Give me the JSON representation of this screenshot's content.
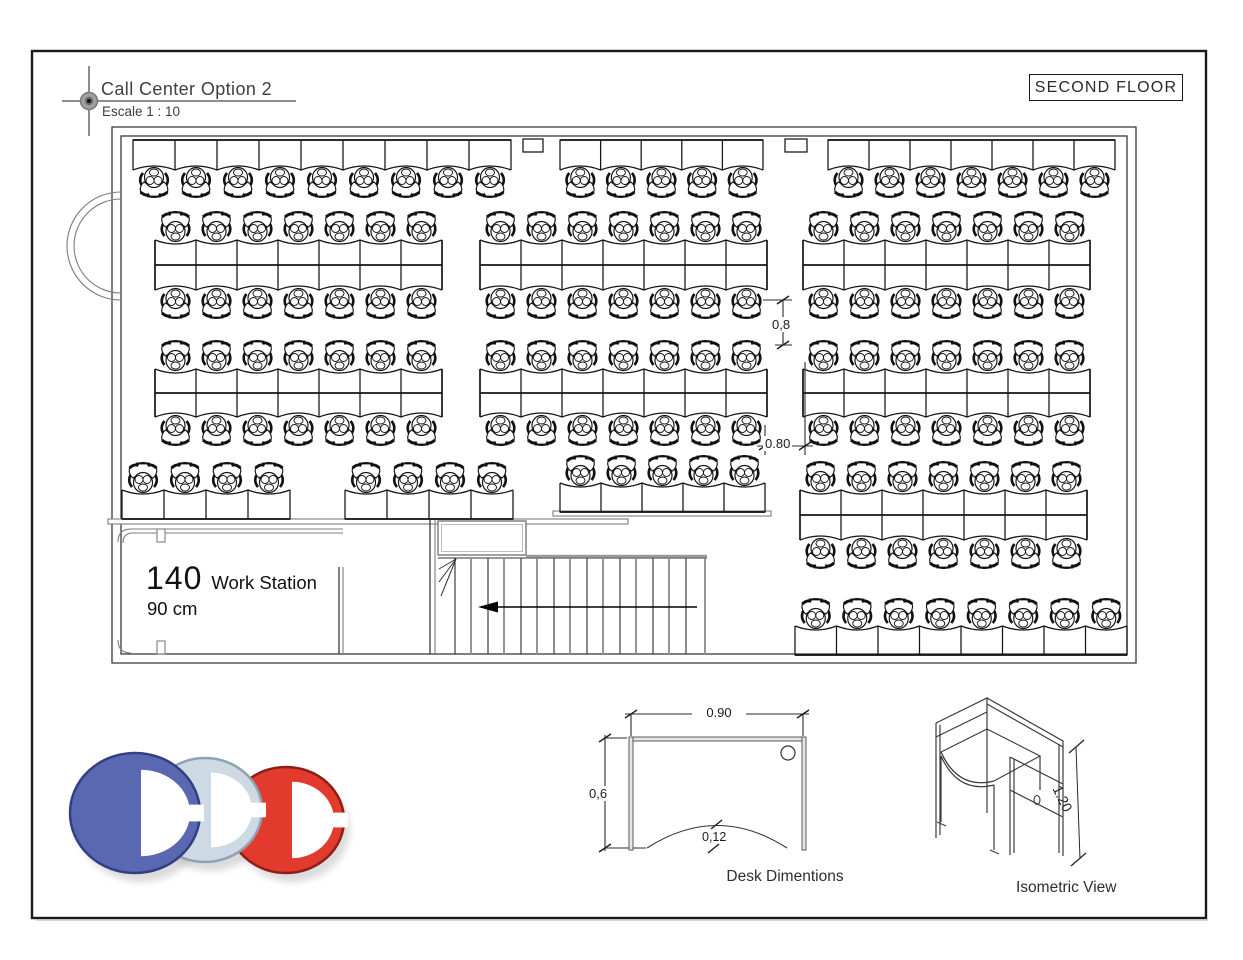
{
  "title_block": {
    "title": "Call Center Option 2",
    "scale": "Escale 1 : 10"
  },
  "floor_label": "SECOND FLOOR",
  "plan": {
    "workstation_count": "140",
    "workstation_label": "Work Station",
    "module_width": "90 cm",
    "aisle_dim_vertical": "0,8",
    "aisle_dim_horizontal": "0.80",
    "desk_groups": [
      {
        "area": "top-wall-left",
        "type": "wall_row",
        "x": 133,
        "y": 140,
        "count": 9,
        "dw": 42,
        "dh": 30
      },
      {
        "area": "top-wall-middle",
        "type": "wall_row",
        "x": 560,
        "y": 140,
        "count": 5,
        "dw": 40.6,
        "dh": 30
      },
      {
        "area": "top-wall-right",
        "type": "wall_row",
        "x": 828,
        "y": 140,
        "count": 7,
        "dw": 41,
        "dh": 30
      },
      {
        "area": "row2-left",
        "type": "double_row",
        "x": 155,
        "y": 240,
        "count": 7,
        "dw": 41,
        "dh": 50
      },
      {
        "area": "row2-middle",
        "type": "double_row",
        "x": 480,
        "y": 240,
        "count": 7,
        "dw": 41,
        "dh": 50
      },
      {
        "area": "row2-right",
        "type": "double_row",
        "x": 803,
        "y": 240,
        "count": 7,
        "dw": 41,
        "dh": 50
      },
      {
        "area": "row3-left",
        "type": "double_row",
        "x": 155,
        "y": 369,
        "count": 7,
        "dw": 41,
        "dh": 48
      },
      {
        "area": "row3-middle",
        "type": "double_row",
        "x": 480,
        "y": 369,
        "count": 7,
        "dw": 41,
        "dh": 48
      },
      {
        "area": "row3-right",
        "type": "double_row",
        "x": 803,
        "y": 369,
        "count": 7,
        "dw": 41,
        "dh": 48
      },
      {
        "area": "row4-left",
        "type": "single_row_up",
        "x": 122,
        "y": 490,
        "count": 4,
        "dw": 42,
        "dh": 29
      },
      {
        "area": "row4-middle",
        "type": "single_row_up",
        "x": 345,
        "y": 490,
        "count": 4,
        "dw": 42,
        "dh": 29
      },
      {
        "area": "row4-right",
        "type": "single_row_up",
        "x": 560,
        "y": 483,
        "count": 5,
        "dw": 41,
        "dh": 29
      },
      {
        "area": "bottom-right-island",
        "type": "double_row",
        "x": 800,
        "y": 490,
        "count": 7,
        "dw": 41,
        "dh": 50
      },
      {
        "area": "bottom-wall",
        "type": "single_row_up",
        "x": 795,
        "y": 626,
        "count": 8,
        "dw": 41.5,
        "dh": 29
      }
    ]
  },
  "desk_diagram": {
    "width": "0.90",
    "depth": "0,6",
    "notch_depth": "0,12",
    "caption": "Desk Dimentions"
  },
  "isometric": {
    "height": "1.20",
    "caption": "Isometric View"
  },
  "logo": {
    "letters": [
      "C",
      "C",
      "C"
    ],
    "colors": {
      "blue": "#5a68b2",
      "light": "#cdd9e3",
      "red": "#e23b2e"
    }
  }
}
